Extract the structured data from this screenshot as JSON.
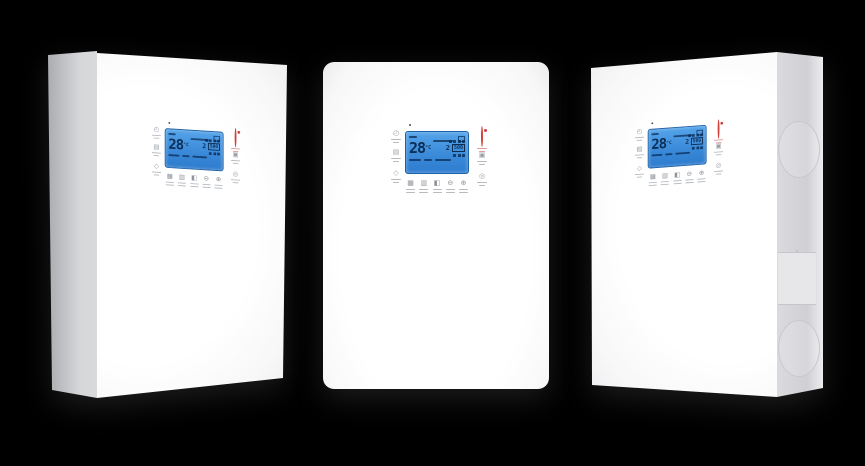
{
  "scene": {
    "background": "#000000",
    "unit_count": 3,
    "description": "three white wall-mounted heating units"
  },
  "panel": {
    "led": {
      "color": "#4a4a4a"
    },
    "lcd": {
      "temperature": "28",
      "temp_unit": "°C",
      "aux_value": "2",
      "boxed_value": "500",
      "background_top": "#55a3e9",
      "background_bottom": "#2d7bcd",
      "border_color": "#1d61a8",
      "text_color": "#0c2d54"
    },
    "left_icons": [
      {
        "name": "timer-icon",
        "glyph": "◴"
      },
      {
        "name": "calendar-icon",
        "glyph": "▤"
      },
      {
        "name": "shield-icon",
        "glyph": "◇"
      }
    ],
    "right_icons": [
      {
        "name": "power-icon",
        "glyph": "",
        "color": "#d2403b"
      },
      {
        "name": "settings-icon",
        "glyph": "▣"
      },
      {
        "name": "status-icon",
        "glyph": "◎"
      }
    ],
    "buttons": [
      {
        "name": "menu-button",
        "glyph": "▦"
      },
      {
        "name": "mode-button",
        "glyph": "▥"
      },
      {
        "name": "display-button",
        "glyph": "◧"
      },
      {
        "name": "minus-button",
        "glyph": "⊖"
      },
      {
        "name": "plus-button",
        "glyph": "⊕"
      }
    ]
  },
  "side_panel": {
    "knockout_count": 2,
    "plate_count": 1
  }
}
